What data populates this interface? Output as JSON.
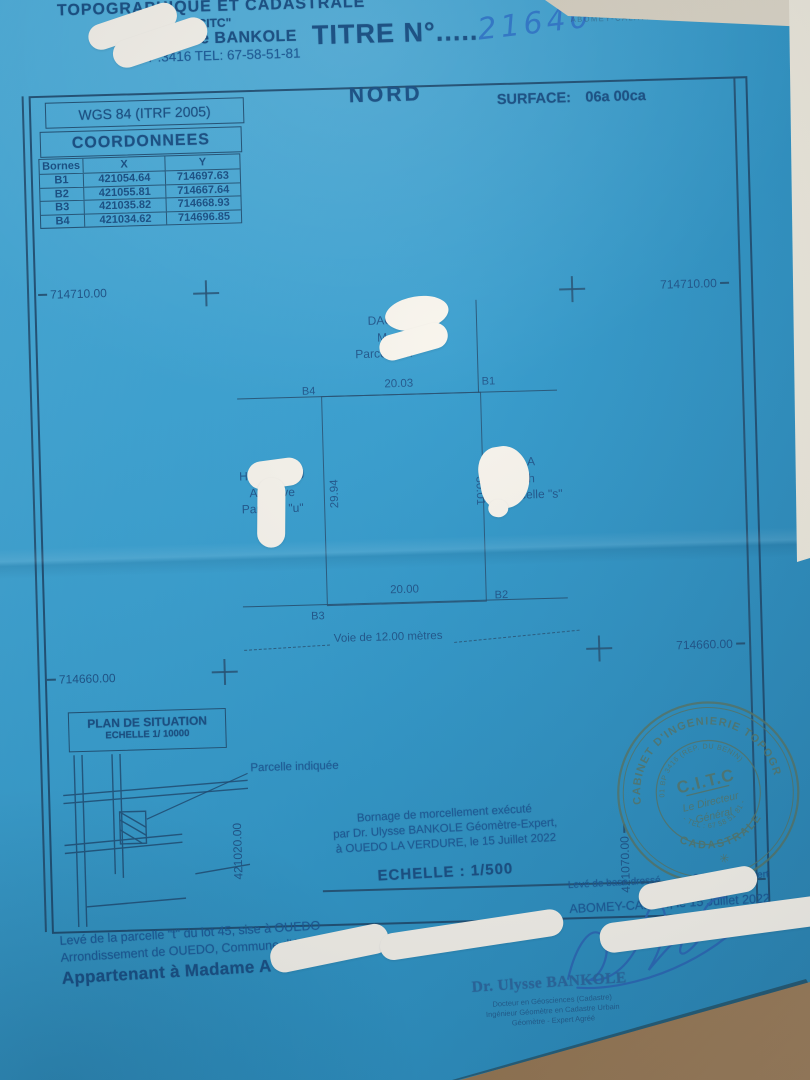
{
  "colors": {
    "paper": "#379fd1",
    "ink": "#1a5a99",
    "plan_line": "#27577d",
    "handwriting": "#2f77c9",
    "stamp_ink": "#53766b",
    "whiteout": "#f8f4ec",
    "desk": "#7b5c3e"
  },
  "header": {
    "office_line1": "TOPOGRAPHIQUE ET CADASTRALE",
    "office_line2": "\"CITC\"",
    "office_line3": "Dr. Ulysse BANKOLE",
    "office_line4": "01BP:3416  TEL: 67-58-51-81",
    "title_label": "TITRE N°",
    "title_dots": ".....",
    "title_number": "21640",
    "corner_note": "ABOMEY-CALAVI"
  },
  "datum_box": {
    "label": "WGS 84 (ITRF 2005)"
  },
  "coordinates": {
    "title": "COORDONNEES",
    "headers": [
      "Bornes",
      "X",
      "Y"
    ],
    "rows": [
      {
        "borne": "B1",
        "x": "421054.64",
        "y": "714697.63"
      },
      {
        "borne": "B2",
        "x": "421055.81",
        "y": "714667.64"
      },
      {
        "borne": "B3",
        "x": "421035.82",
        "y": "714668.93"
      },
      {
        "borne": "B4",
        "x": "421034.62",
        "y": "714696.85"
      }
    ]
  },
  "compass": "NORD",
  "surface": {
    "label": "SURFACE:",
    "value": "06a 00ca"
  },
  "plan": {
    "grid": {
      "top_left": "714710.00",
      "top_right": "714710.00",
      "bottom_left": "714660.00",
      "bottom_right": "714660.00",
      "vertical_left": "421020.00",
      "vertical_right": "421070.00"
    },
    "corners": {
      "top_left": "B4",
      "top_right": "B1",
      "bottom_right": "B2",
      "bottom_left": "B3"
    },
    "dimensions": {
      "top": "20.03",
      "right": "30.01",
      "bottom": "20.00",
      "left": "29.94"
    },
    "neighbor_top": {
      "line1": "DAOU",
      "line2": "Mo",
      "line3": "Parcelle \"k\""
    },
    "neighbor_left": {
      "line1": "HOUN  NOU",
      "line2": "Arle  Eve",
      "line3": "Parcelle \"u\""
    },
    "neighbor_right": {
      "line1": "A",
      "line2": "h",
      "line3": "Parcelle \"s\""
    },
    "road": "Voie de 12.00 mètres"
  },
  "situation": {
    "title": "PLAN DE SITUATION",
    "scale": "ECHELLE 1/ 10000",
    "callout": "Parcelle indiquée"
  },
  "certification": {
    "line1": "Bornage de morcellement exécuté",
    "line2": "par Dr. Ulysse BANKOLE Géomètre-Expert,",
    "line3": "à OUEDO LA VERDURE, le 15 Juillet 2022",
    "scale": "ECHELLE : 1/500"
  },
  "stamp": {
    "outer_top": "CABINET D'INGENIERIE TOPOGRAPHIQUE ET",
    "outer_bottom": "CADASTRALE",
    "inner_top": "01 BP 3416 (REP. DU BENIN)",
    "inner_bottom": "- TEL : 67 58 51 81 -",
    "center": "C.I.T.C",
    "dir1": "Le Directeur",
    "dir2": "Général",
    "star": "✳"
  },
  "base_survey": {
    "line1a": "Levé de base dressé",
    "line1b": "Géomètre-Expert",
    "line2": "Basile O.",
    "line3": "ABOMEY-CALAVI, le 15 Juillet 2022"
  },
  "footer": {
    "line1": "Levé de la parcelle \"t\" du lot 45, sise à OUEDO",
    "line2": "Arrondissement de OUEDO, Commune d'ABOMEY-CALAVI",
    "line3": "Appartenant à Madame A"
  },
  "surveyor": {
    "name": "Dr. Ulysse BANKOLE",
    "title1": "Docteur en Géosciences (Cadastre)",
    "title2": "Ingénieur Géomètre en Cadastre Urbain",
    "title3": "Géomètre - Expert Agréé"
  }
}
